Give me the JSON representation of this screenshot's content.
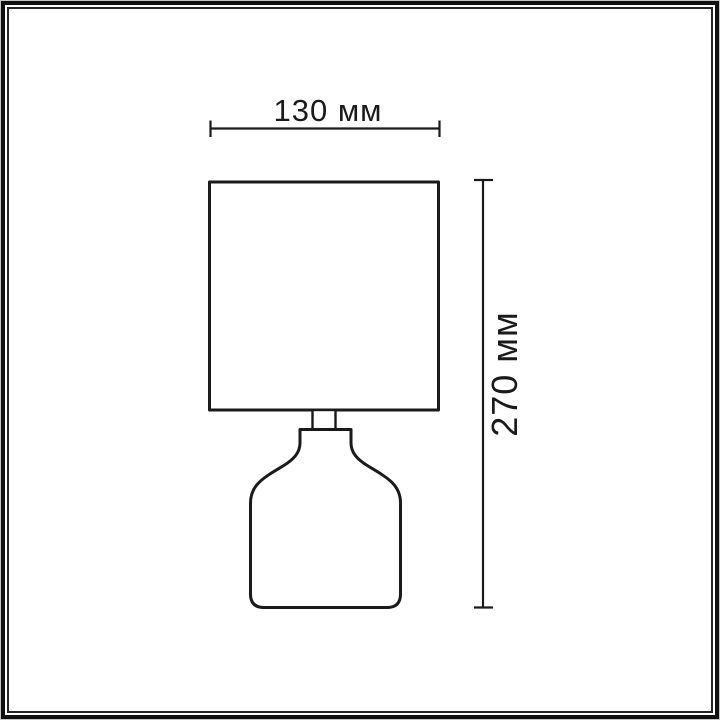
{
  "diagram": {
    "kind": "product dimension drawing",
    "subject": "table lamp with square shade and bottle-shaped base"
  },
  "dimensions": {
    "width": {
      "label": "130 мм",
      "value": 130,
      "unit": "мм"
    },
    "height": {
      "label": "270 мм",
      "value": 270,
      "unit": "мм"
    }
  },
  "colors": {
    "background": "#ffffff",
    "line": "#1a1a1a",
    "frame_outer": "#101010",
    "frame_inner": "#242424"
  }
}
